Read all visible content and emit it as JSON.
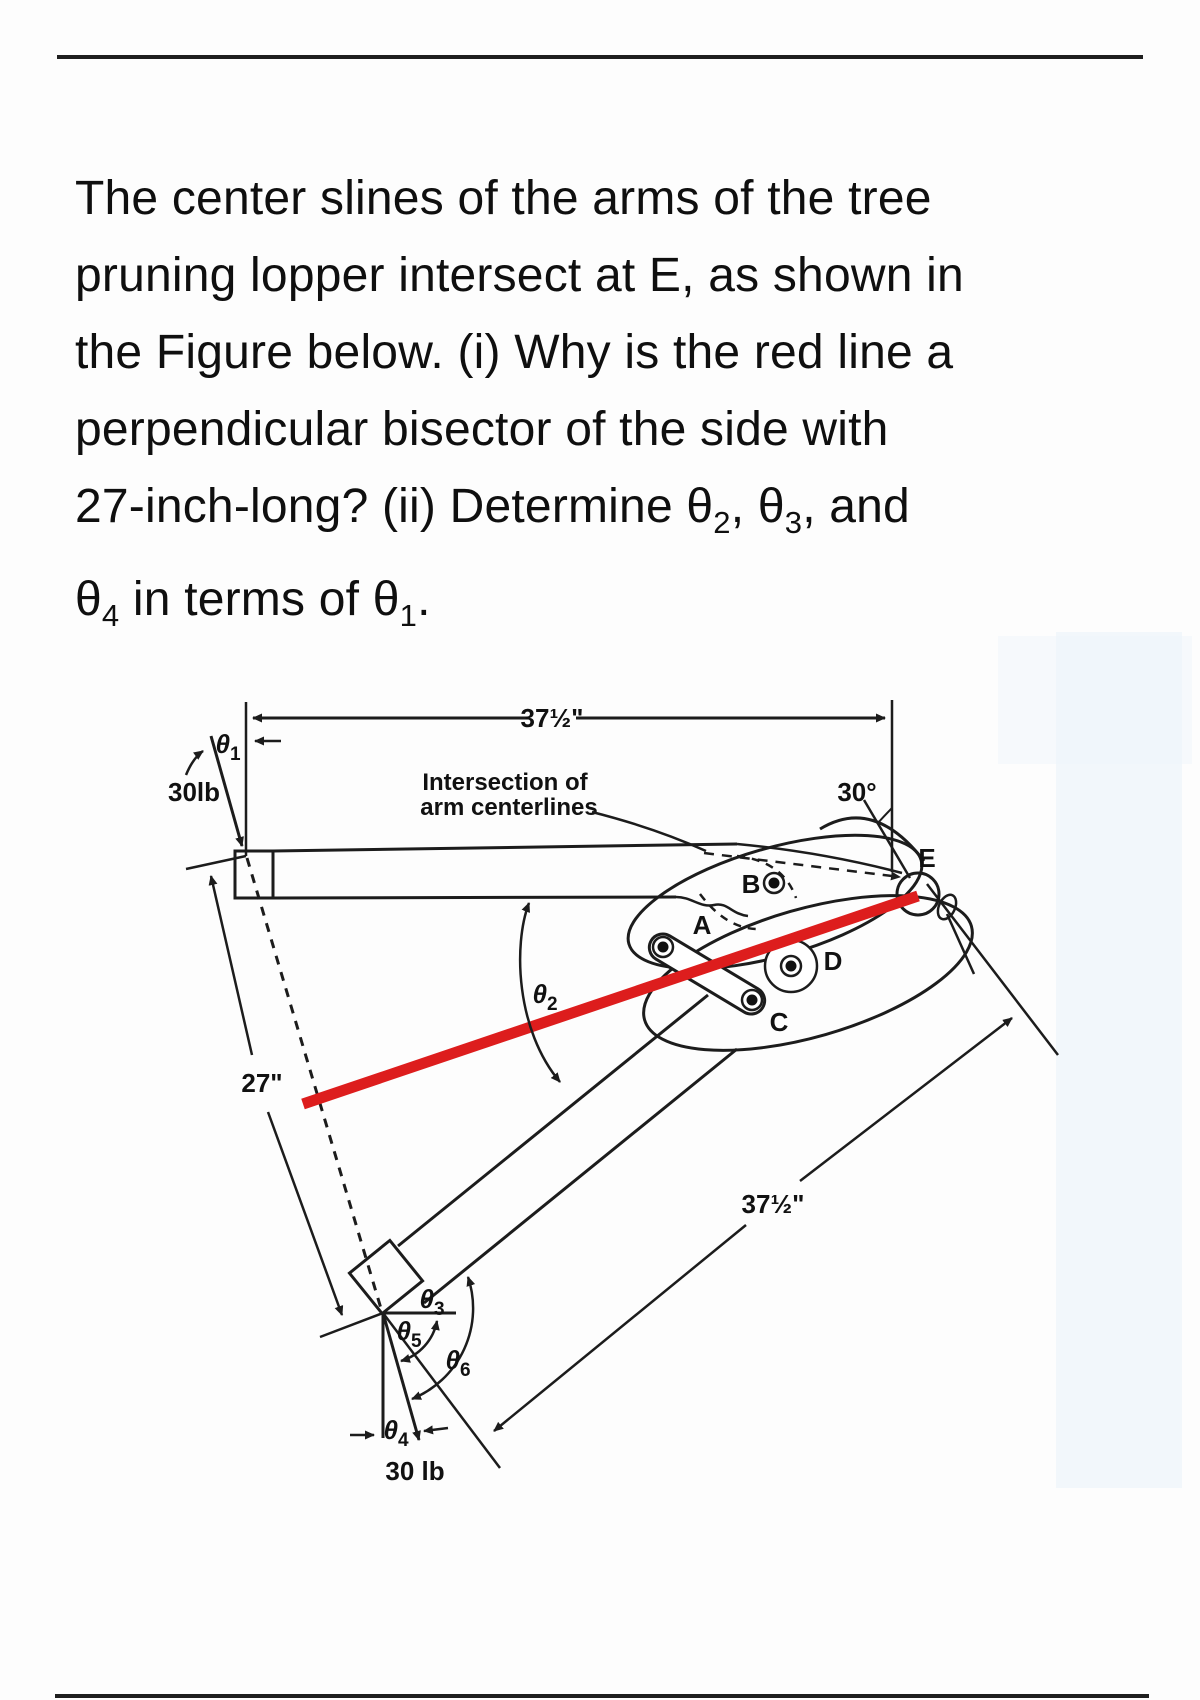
{
  "colors": {
    "red_line": "#dd1d1d",
    "ink": "#1c1c1c",
    "page_bg": "#fdfdfd",
    "tint_band": "#eaf2f9"
  },
  "problem_text": {
    "lines": [
      [
        {
          "t": "The center slines of the arms of the tree"
        }
      ],
      [
        {
          "t": "pruning lopper intersect at E, as shown in"
        }
      ],
      [
        {
          "t": "the Figure below. (i) Why is the red line a"
        }
      ],
      [
        {
          "t": "perpendicular bisector of the side with"
        }
      ],
      [
        {
          "t": "27-inch-long? (ii) Determine "
        },
        {
          "t": "θ"
        },
        {
          "t": "2",
          "sub": true
        },
        {
          "t": ", "
        },
        {
          "t": "θ"
        },
        {
          "t": "3",
          "sub": true
        },
        {
          "t": ", and"
        }
      ],
      [
        {
          "t": "θ"
        },
        {
          "t": "4",
          "sub": true
        },
        {
          "t": " in terms of "
        },
        {
          "t": "θ"
        },
        {
          "t": "1",
          "sub": true
        },
        {
          "t": "."
        }
      ]
    ]
  },
  "figure": {
    "dim_top": "37½\"",
    "dim_bottom": "37½\"",
    "dim_side": "27\"",
    "force_top": "30lb",
    "force_bottom": "30 lb",
    "angle_30": "30°",
    "note_line1": "Intersection of",
    "note_line2": "arm centerlines",
    "points": {
      "A": "A",
      "B": "B",
      "C": "C",
      "D": "D",
      "E": "E"
    },
    "theta": {
      "t1": {
        "sym": "θ",
        "sub": "1"
      },
      "t2": {
        "sym": "θ",
        "sub": "2"
      },
      "t3": {
        "sym": "θ",
        "sub": "3"
      },
      "t4": {
        "sym": "θ",
        "sub": "4"
      },
      "t5": {
        "sym": "θ",
        "sub": "5"
      },
      "t6": {
        "sym": "θ",
        "sub": "6"
      }
    }
  }
}
